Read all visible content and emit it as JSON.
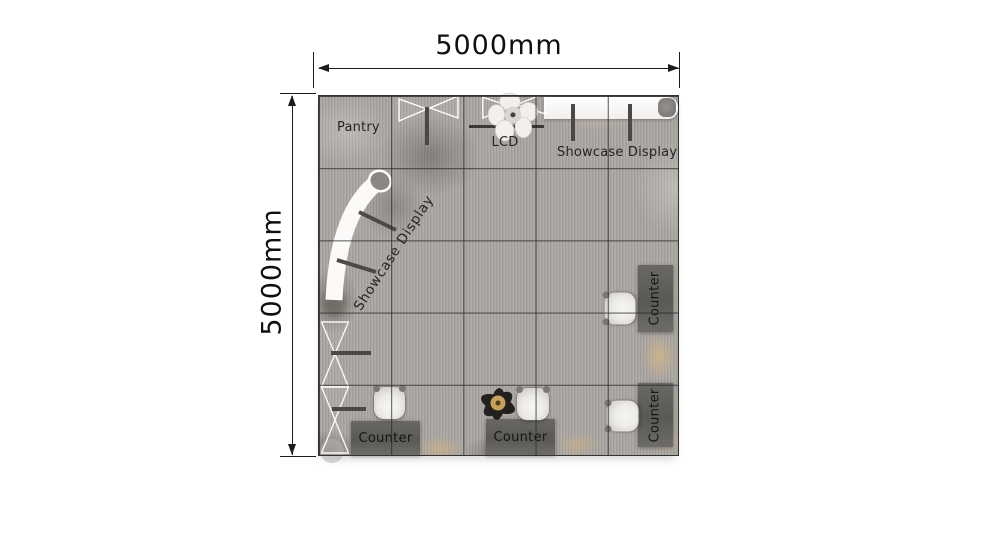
{
  "dimensions": {
    "top_label": "5000mm",
    "left_label": "5000mm"
  },
  "areas": {
    "pantry_label": "Pantry"
  },
  "displays": {
    "lcd_label": "LCD",
    "showcase_top_label": "Showcase Display",
    "showcase_curved_label": "Showcase Display"
  },
  "counters": {
    "bottom_left_label": "Counter",
    "bottom_center_label": "Counter",
    "right_upper_label": "Counter",
    "right_lower_label": "Counter"
  },
  "grid": {
    "rows": 5,
    "cols": 5
  },
  "icons": {
    "folding_display": "bowtie-outline",
    "meeting_table": "round-table-with-chairs-top-view",
    "showcase_shelf": "white-shelf-strip",
    "curved_showcase": "white-arc-counter",
    "truss": "triangle-zigzag-outline",
    "chair": "rounded-armchair-top-view",
    "person": "person-top-view",
    "dimension_arrows": "double-headed-arrow"
  },
  "colors": {
    "background": "#ffffff",
    "floor_base": "#a8a4a0",
    "floor_tan_accent": "#cdb48c",
    "grid_line": "#333330",
    "counter_fill": "#5b5956",
    "showcase_white": "#ffffff",
    "dimension_ink": "#1c1c1c",
    "label_text": "#252525",
    "person_skin": "#c9a058"
  }
}
